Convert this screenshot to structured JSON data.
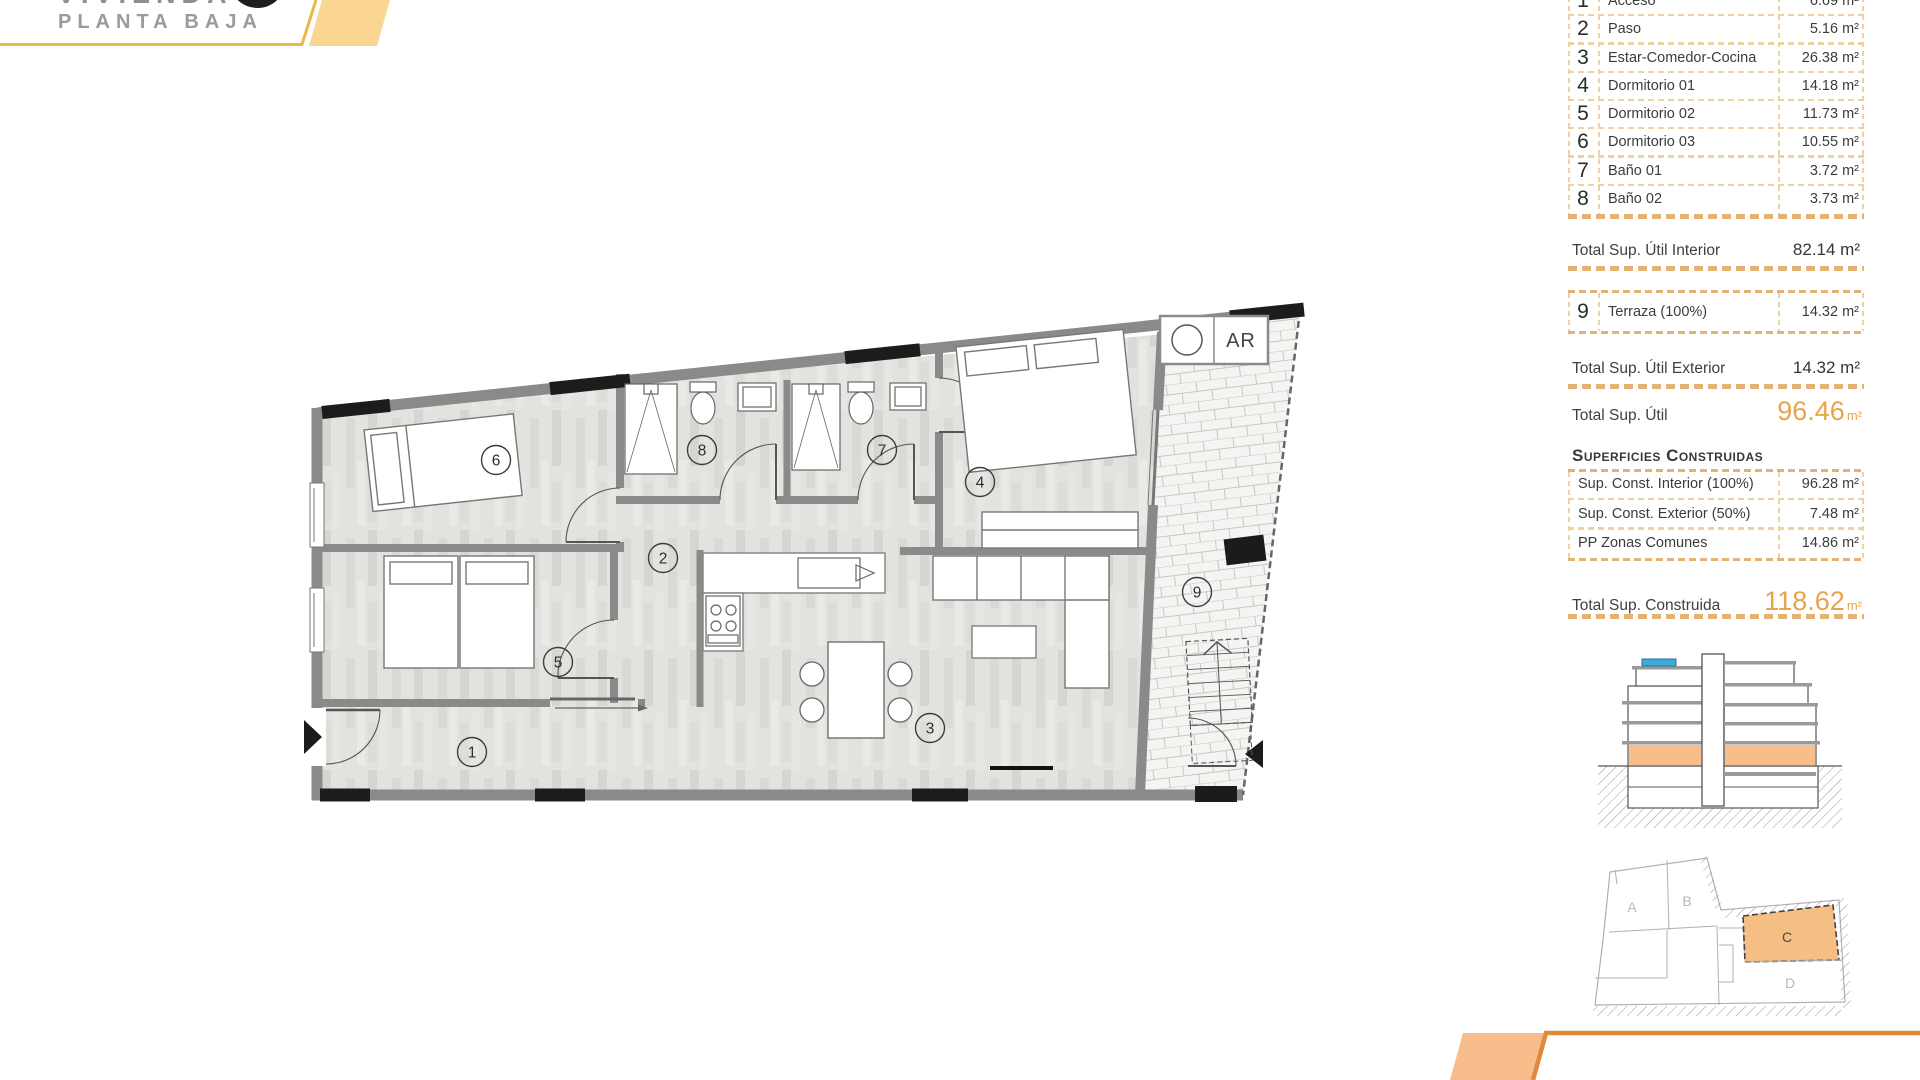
{
  "header": {
    "title": "VIVIENDA",
    "subtitle": "PLANTA BAJA"
  },
  "surface_table": {
    "rows": [
      {
        "num": "1",
        "name": "Acceso",
        "area": "6.69 m²"
      },
      {
        "num": "2",
        "name": "Paso",
        "area": "5.16 m²"
      },
      {
        "num": "3",
        "name": "Estar-Comedor-Cocina",
        "area": "26.38 m²"
      },
      {
        "num": "4",
        "name": "Dormitorio 01",
        "area": "14.18 m²"
      },
      {
        "num": "5",
        "name": "Dormitorio 02",
        "area": "11.73 m²"
      },
      {
        "num": "6",
        "name": "Dormitorio 03",
        "area": "10.55 m²"
      },
      {
        "num": "7",
        "name": "Baño 01",
        "area": "3.72 m²"
      },
      {
        "num": "8",
        "name": "Baño 02",
        "area": "3.73 m²"
      }
    ],
    "total_interior": {
      "label": "Total Sup. Útil Interior",
      "value": "82.14 m²"
    },
    "terraza_row": {
      "num": "9",
      "name": "Terraza (100%)",
      "area": "14.32 m²"
    },
    "total_exterior": {
      "label": "Total Sup. Útil Exterior",
      "value": "14.32 m²"
    },
    "total_util": {
      "label": "Total Sup. Útil",
      "value": "96.46",
      "unit": "m²"
    }
  },
  "construidas": {
    "heading": "Superficies Construidas",
    "rows": [
      {
        "name": "Sup. Const. Interior (100%)",
        "area": "96.28 m²"
      },
      {
        "name": "Sup. Const. Exterior (50%)",
        "area": "7.48 m²"
      },
      {
        "name": "PP Zonas Comunes",
        "area": "14.86 m²"
      }
    ],
    "total": {
      "label": "Total Sup. Construida",
      "value": "118.62",
      "unit": "m²"
    }
  },
  "floor_plan": {
    "rooms": {
      "r1": "1",
      "r2": "2",
      "r3": "3",
      "r4": "4",
      "r5": "5",
      "r6": "6",
      "r7": "7",
      "r8": "8",
      "r9": "9"
    },
    "ar_label": "AR"
  },
  "site_plan": {
    "blocks": {
      "a": "A",
      "b": "B",
      "c": "C",
      "d": "D"
    }
  },
  "colors": {
    "accent_orange": "#E8A44B",
    "band_yellow": "#EBB945",
    "band_fill_top": "#FBD592",
    "band_fill_bottom": "#F7BD8C",
    "band_line_bottom": "#E2883B",
    "dash_tan": "#E4B272",
    "highlight_block": "#F5BE83",
    "section_ground_floor": "#F7BE8B",
    "solar_blue": "#3FA9D8"
  }
}
